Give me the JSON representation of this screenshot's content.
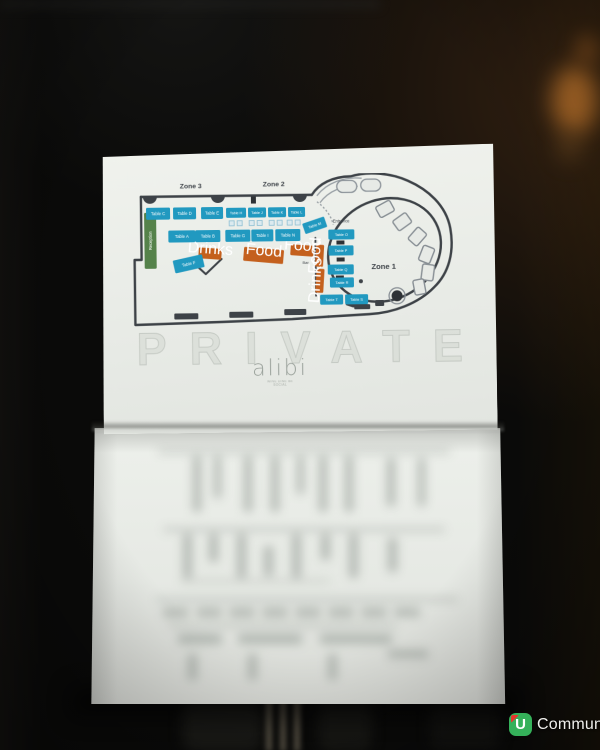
{
  "floor_plan": {
    "zones": [
      {
        "label": "Zone 3"
      },
      {
        "label": "Zone 2"
      },
      {
        "label": "Zone 1"
      }
    ],
    "entrance_label": "Entrance",
    "bar_label": "Bar",
    "reception_label": "Reception",
    "stations": [
      {
        "id": "drinks",
        "label": "Drinks"
      },
      {
        "id": "food-main",
        "label": "Food"
      },
      {
        "id": "food-side",
        "label": "Food"
      },
      {
        "id": "food-vertical",
        "label": "Food"
      },
      {
        "id": "drinks-vertical",
        "label": "Drinks"
      }
    ],
    "tables": [
      {
        "label": "Table C"
      },
      {
        "label": "Table D"
      },
      {
        "label": "Table E"
      },
      {
        "label": "Table H"
      },
      {
        "label": "Table J"
      },
      {
        "label": "Table K"
      },
      {
        "label": "Table L"
      },
      {
        "label": "Table A"
      },
      {
        "label": "Table B"
      },
      {
        "label": "Table G"
      },
      {
        "label": "Table I"
      },
      {
        "label": "Table N"
      },
      {
        "label": "Table M"
      },
      {
        "label": "Table O"
      },
      {
        "label": "Table P"
      },
      {
        "label": "Table Q"
      },
      {
        "label": "Table R"
      },
      {
        "label": "Table T"
      },
      {
        "label": "Table S"
      },
      {
        "label": "Table F"
      }
    ]
  },
  "branding": {
    "watermark": "PRIVATE",
    "venue_logo": "alibi",
    "venue_tagline": "WINE DINE BE SOCIAL"
  },
  "photo_credit": {
    "badge_letter": "U",
    "brand_name": "Community"
  },
  "colors": {
    "table_teal": "#2199c0",
    "station_orange": "#c4601d",
    "reception_green": "#55824a",
    "wall_gray": "#3d4247",
    "paper": "#e9ece7",
    "ucommunity_green": "#35b15a",
    "ucommunity_red": "#e5362c"
  }
}
